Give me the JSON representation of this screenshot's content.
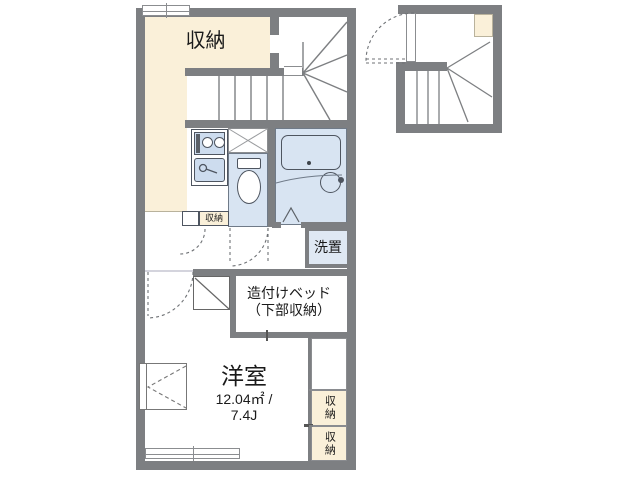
{
  "colors": {
    "wall": "#7d7f82",
    "cream": "#faf0d9",
    "wet": "#d8e4f2",
    "laundry": "#dfe8f3",
    "kitchen_fill": "#cddcee",
    "line": "#6f7276",
    "fixture": "#4e5560",
    "border": "#8b8d90",
    "text": "#1a1a1a"
  },
  "labels": {
    "storage_main": "収納",
    "storage_small": "収納",
    "laundry": "洗置",
    "bed_line1": "造付けベッド",
    "bed_line2": "（下部収納）",
    "room_name": "洋室",
    "room_area": "12.04㎡ /",
    "room_jo": "7.4J",
    "closet_top": "収納",
    "closet_bottom": "収納"
  }
}
